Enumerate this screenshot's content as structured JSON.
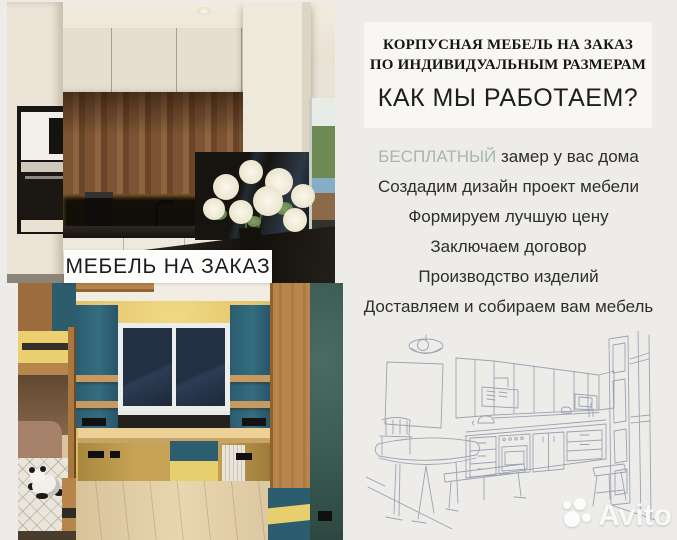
{
  "ad": {
    "photo_label": "МЕБЕЛЬ НА ЗАКАЗ",
    "header": {
      "line1": "КОРПУСНАЯ МЕБЕЛЬ НА ЗАКАЗ",
      "line2": "ПО ИНДИВИДУАЛЬНЫМ РАЗМЕРАМ",
      "title": "КАК МЫ РАБОТАЕМ?"
    },
    "steps": [
      {
        "prefix": "БЕСПЛАТНЫЙ",
        "text": " замер у вас дома"
      },
      {
        "prefix": "",
        "text": "Создадим дизайн проект мебели"
      },
      {
        "prefix": "",
        "text": "Формируем лучшую цену"
      },
      {
        "prefix": "",
        "text": "Заключаем договор"
      },
      {
        "prefix": "",
        "text": "Производство изделий"
      },
      {
        "prefix": "",
        "text": "Доставляем и собираем вам мебель"
      }
    ],
    "watermark": {
      "brand": "Avito"
    },
    "colors": {
      "highlight": "#a7b6b1",
      "page_bg": "#eeece9",
      "card_bg": "#f9f7f4",
      "label_bg": "#fdfdfc",
      "text": "#2d2d2d",
      "sketch_stroke": "#8d97a9"
    }
  }
}
